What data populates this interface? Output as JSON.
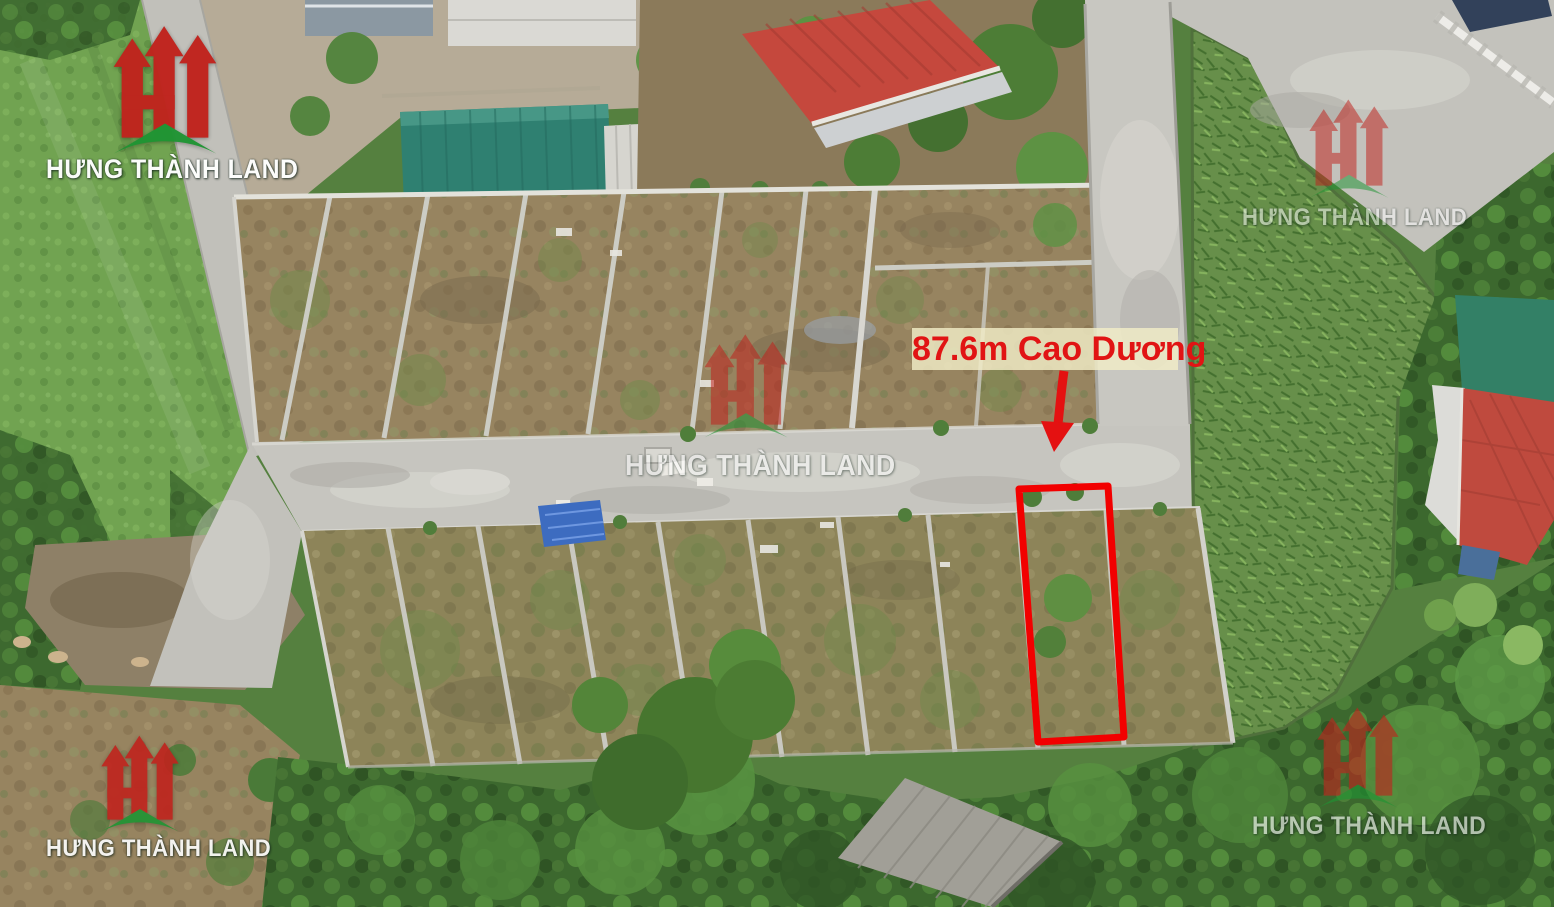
{
  "branding": {
    "company_name": "HƯNG THÀNH LAND",
    "logo_icon": "ht-monogram-logo",
    "brand_red": "#c0231d",
    "brand_green": "#1f9433",
    "watermark_text_color": "#ffffff"
  },
  "annotation": {
    "label": "87.6m Cao Dương",
    "label_text_color": "#e11414",
    "label_background": "#f1edc7",
    "arrow_icon": "red-down-arrow",
    "arrow_color": "#e41111",
    "plot_outline_color": "#f20000"
  }
}
